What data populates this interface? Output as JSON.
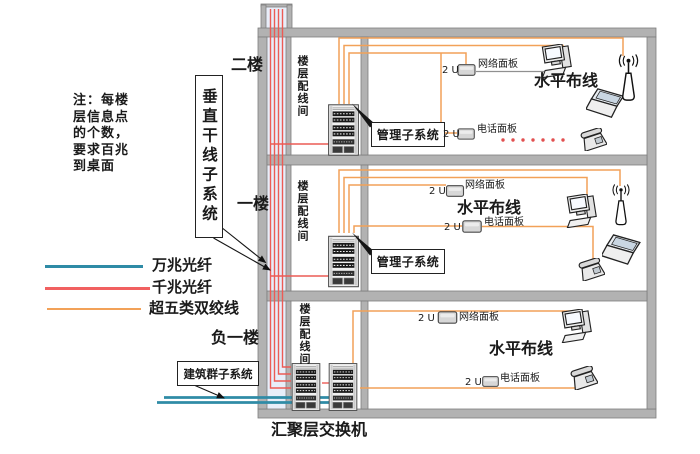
{
  "note": {
    "text": "注：每楼\n层信息点\n的个数，\n要求百兆\n到桌面"
  },
  "legend": {
    "items": [
      {
        "label": "万兆光纤",
        "color": "#2F8BA6"
      },
      {
        "label": "千兆光纤",
        "color": "#F16060"
      },
      {
        "label": "超五类双绞线",
        "color": "#F2A158"
      }
    ]
  },
  "vertical_trunk": {
    "label": "垂直干线子系统"
  },
  "building_group": {
    "label": "建筑群子系统"
  },
  "aggregation_switch": {
    "label": "汇聚层交换机"
  },
  "panel_unit_label": "2 U",
  "floors": [
    {
      "name": "floor-2",
      "label": "二楼",
      "room_label": "楼层配线间",
      "management_label": "管理子系统",
      "network_panel_label": "网络面板",
      "phone_panel_label": "电话面板",
      "horizontal_label": "水平布线"
    },
    {
      "name": "floor-1",
      "label": "一楼",
      "room_label": "楼层配线间",
      "management_label": "管理子系统",
      "network_panel_label": "网络面板",
      "phone_panel_label": "电话面板",
      "horizontal_label": "水平布线"
    },
    {
      "name": "basement-1",
      "label": "负一楼",
      "room_label": "楼层配线间",
      "network_panel_label": "网络面板",
      "phone_panel_label": "电话面板",
      "horizontal_label": "水平布线"
    }
  ]
}
